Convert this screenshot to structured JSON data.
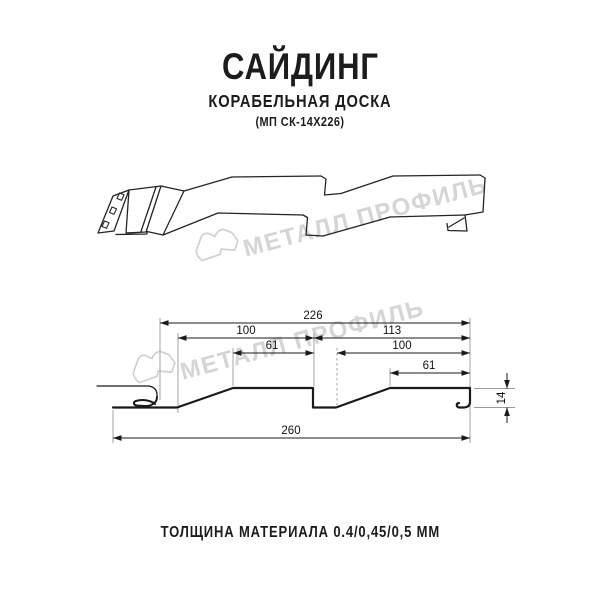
{
  "header": {
    "title": "САЙДИНГ",
    "subtitle": "КОРАБЕЛЬНАЯ ДОСКА",
    "product_code": "(МП СК-14Х226)"
  },
  "watermark": {
    "brand": "МЕТАЛЛ ПРОФИЛЬ",
    "color": "#d5d5d5"
  },
  "drawing": {
    "type": "siding-profile-technical-diagram",
    "views": "perspective and cross-section",
    "dimensions_mm": {
      "overall_module_width": 226,
      "panel_width_left": 100,
      "top_flat_left": 61,
      "right_span": 113,
      "panel_width_right": 100,
      "top_flat_right": 61,
      "total_width": 260,
      "profile_height": 14
    },
    "dims": {
      "w226": "226",
      "w100a": "100",
      "w113": "113",
      "w61a": "61",
      "w100b": "100",
      "w61b": "61",
      "w260": "260",
      "h14": "14"
    }
  },
  "footer": {
    "thickness_label": "ТОЛЩИНА МАТЕРИАЛА 0.4/0,45/0,5 ММ"
  },
  "colors": {
    "line": "#1a1a1a",
    "extension_line": "#9a9a9a",
    "text": "#1c1c1c",
    "watermark": "#d5d5d5",
    "background": "#ffffff"
  }
}
